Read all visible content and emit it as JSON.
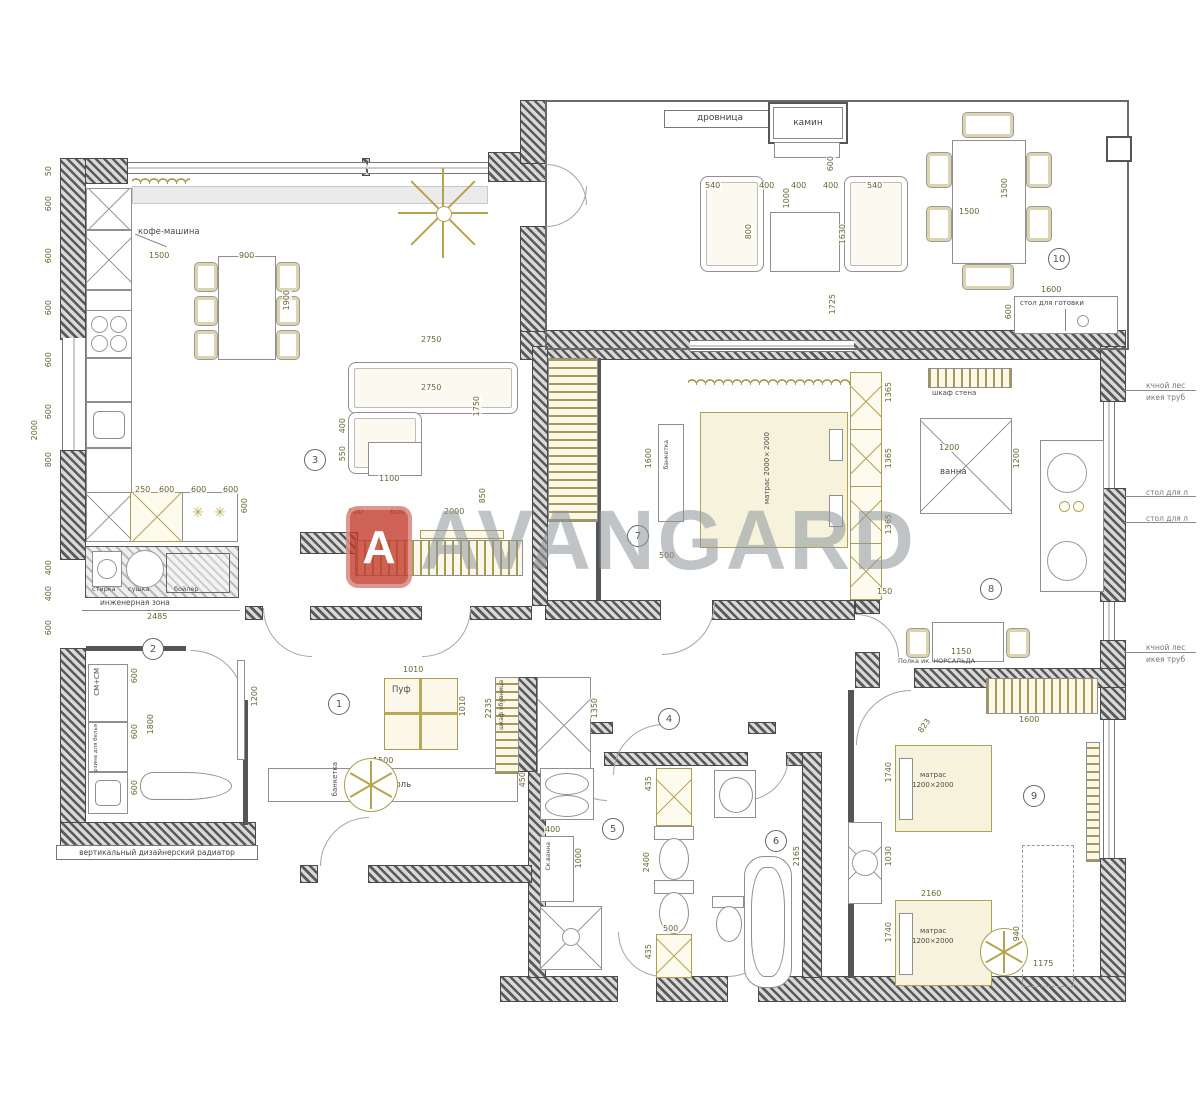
{
  "watermark": {
    "logo_letter": "A",
    "brand": "AVANGARD"
  },
  "room_numbers": {
    "r1": "1",
    "r2": "2",
    "r3": "3",
    "r4": "4",
    "r5": "5",
    "r6": "6",
    "r7": "7",
    "r8": "8",
    "r9": "9",
    "r10": "10"
  },
  "labels": {
    "drovnitsa": "дровница",
    "kamin": "камин",
    "stol_gotovki": "стол для готовки",
    "kofe": "кофе-машина",
    "stirka": "стирка",
    "sushka": "сушка",
    "boyler": "бойлер",
    "inzh_zona": "инженерная зона",
    "sm_sm": "СМ+СМ",
    "korzina": "корзина для белья",
    "radiator": "вертикальный дизайнерский радиатор",
    "puf": "Пуф",
    "konsol": "консоль",
    "banketka": "банкетка",
    "shkaf_obuv": "шкаф обувница",
    "matras2000": "матрас 2000×2000",
    "matras": "матрас",
    "m1200": "1200×2000",
    "shkaf_stena": "шкаф стена",
    "vanna": "ванна",
    "polka": "Полка ик. НОРСАЛЬДА",
    "sk_vanna": "Ск.ванна",
    "ann_lestnica": "кчной лес",
    "ann_ikea": "икея труб",
    "ann_stol": "стол для л"
  },
  "icons": {
    "burner": "✳"
  },
  "dims": {
    "d50": "50",
    "d150": "150",
    "d250": "250",
    "d400": "400",
    "d435": "435",
    "d450": "450",
    "d500": "500",
    "d540": "540",
    "d550": "550",
    "d600": "600",
    "d790": "790",
    "d800": "800",
    "d823": "823",
    "d850": "850",
    "d900": "900",
    "d940": "940",
    "d1000": "1000",
    "d1010": "1010",
    "d1030": "1030",
    "d1100": "1100",
    "d1150": "1150",
    "d1175": "1175",
    "d1200": "1200",
    "d1350": "1350",
    "d1365": "1365",
    "d1500": "1500",
    "d1600": "1600",
    "d1630": "1630",
    "d1725": "1725",
    "d1740": "1740",
    "d1750": "1750",
    "d1800": "1800",
    "d1900": "1900",
    "d2000": "2000",
    "d2065": "2065",
    "d2160": "2160",
    "d2165": "2165",
    "d2235": "2235",
    "d2400": "2400",
    "d2485": "2485",
    "d2750": "2750"
  }
}
